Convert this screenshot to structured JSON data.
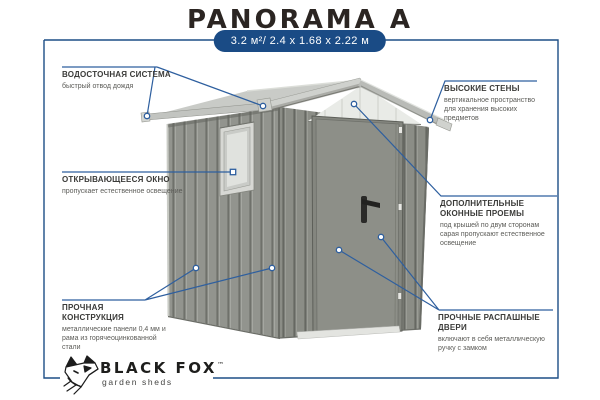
{
  "header": {
    "title": "PANORAMA A",
    "badge": "3.2 м²/ 2.4 x 1.68 x 2.22 м"
  },
  "callouts": {
    "left": [
      {
        "title": "ВОДОСТОЧНАЯ СИСТЕМА",
        "desc": "быстрый отвод дождя"
      },
      {
        "title": "ОТКРЫВАЮЩЕЕСЯ ОКНО",
        "desc": "пропускает естественное освещение"
      },
      {
        "title": "ПРОЧНАЯ КОНСТРУКЦИЯ",
        "desc": "металлические панели 0,4 мм и рама из горячеоцинкованной стали"
      }
    ],
    "right": [
      {
        "title": "ВЫСОКИЕ СТЕНЫ",
        "desc": "вертикальное пространство для хранения высоких предметов"
      },
      {
        "title": "ДОПОЛНИТЕЛЬНЫЕ ОКОННЫЕ ПРОЕМЫ",
        "desc": "под крышей по двум сторонам сарая пропускают естественное освещение"
      },
      {
        "title": "ПРОЧНЫЕ РАСПАШНЫЕ ДВЕРИ",
        "desc": "включают в себя металлическую ручку с замком"
      }
    ]
  },
  "brand": {
    "name": "BLACK FOX",
    "tm": "™",
    "tagline": "garden sheds"
  },
  "illustration": {
    "name": "metal-garden-shed-3d-view"
  },
  "colors": {
    "accent_navy": "#1d4e86",
    "callout_line": "#2e5f9f",
    "title_text": "#2b2522",
    "badge_bg": "#1a4b85",
    "badge_text": "#ffffff",
    "wall_gray": "#8f918b",
    "roof_gray": "#c6c8c4",
    "door_gray": "#8d8f88"
  }
}
